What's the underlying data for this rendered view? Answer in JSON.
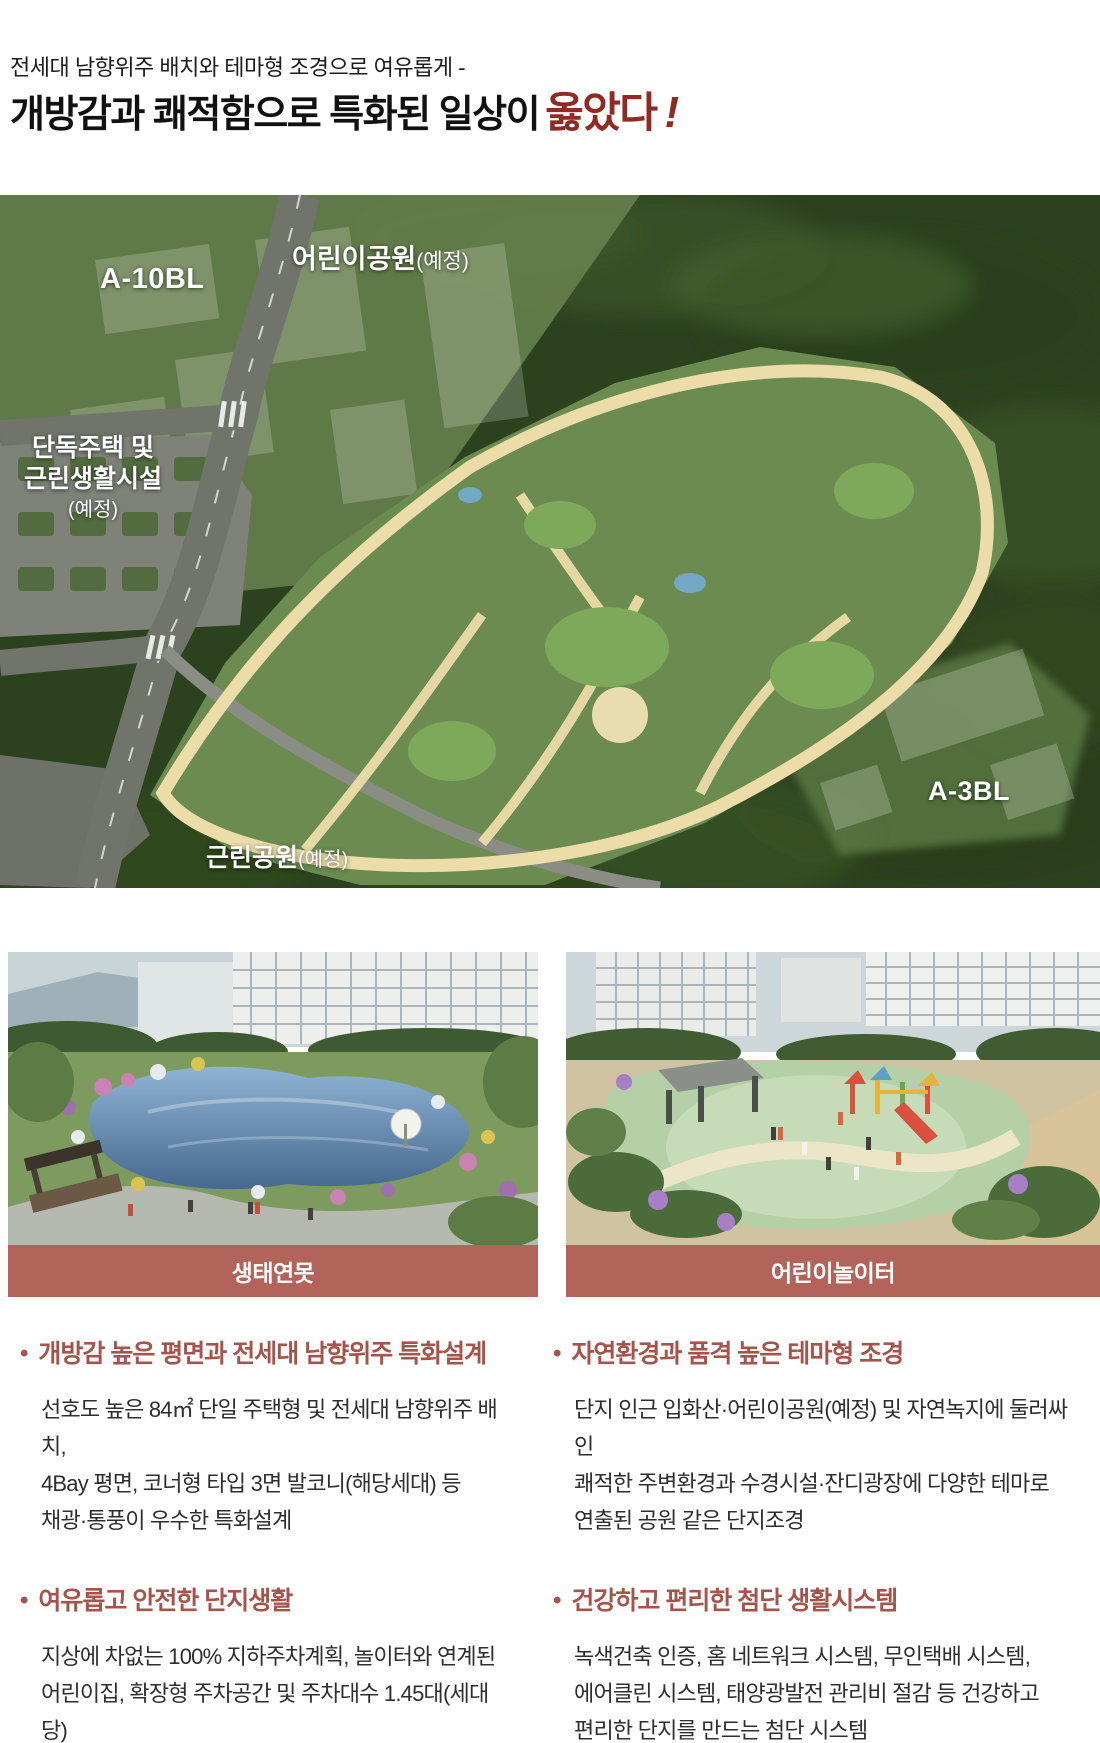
{
  "headline": {
    "kicker": "전세대 남향위주 배치와 테마형 조경으로 여유롭게 -",
    "title_black": "개방감과 쾌적함으로 특화된 일상이",
    "title_red": "옳았다",
    "title_bang": "!"
  },
  "siteplan": {
    "labels": {
      "children_park_main": "어린이공원",
      "children_park_sub": "(예정)",
      "block_a10": "A-10BL",
      "housing_line1": "단독주택 및",
      "housing_line2": "근린생활시설",
      "housing_line3": "(예정)",
      "neighborhood_park_main": "근린공원",
      "neighborhood_park_sub": "(예정)",
      "block_a3": "A-3BL"
    }
  },
  "photos": [
    {
      "caption": "생태연못"
    },
    {
      "caption": "어린이놀이터"
    }
  ],
  "features": [
    {
      "title": "개방감 높은 평면과 전세대 남향위주 특화설계",
      "lines": [
        "선호도 높은 84㎡ 단일 주택형 및 전세대 남향위주 배치,",
        "4Bay 평면, 코너형 타입 3면 발코니(해당세대) 등",
        "채광·통풍이 우수한 특화설계"
      ]
    },
    {
      "title": "자연환경과 품격 높은 테마형 조경",
      "lines": [
        "단지 인근 입화산·어린이공원(예정) 및 자연녹지에 둘러싸인",
        "쾌적한 주변환경과 수경시설·잔디광장에 다양한 테마로",
        "연출된 공원 같은 단지조경"
      ]
    },
    {
      "title": "여유롭고 안전한 단지생활",
      "lines": [
        "지상에 차없는 100% 지하주차계획, 놀이터와 연계된",
        "어린이집, 확장형 주차공간 및 주차대수 1.45대(세대당)",
        "확보로 넉넉하고 안전한 공간활용과 동선계획"
      ]
    },
    {
      "title": "건강하고 편리한 첨단 생활시스템",
      "lines": [
        "녹색건축 인증, 홈 네트워크 시스템, 무인택배 시스템,",
        "에어클린 시스템, 태양광발전 관리비 절감 등 건강하고",
        "편리한 단지를 만드는 첨단 시스템"
      ]
    }
  ],
  "colors": {
    "accent_red": "#8f2a24",
    "feature_red": "#a5544b",
    "caption_bar": "#b2635a"
  }
}
